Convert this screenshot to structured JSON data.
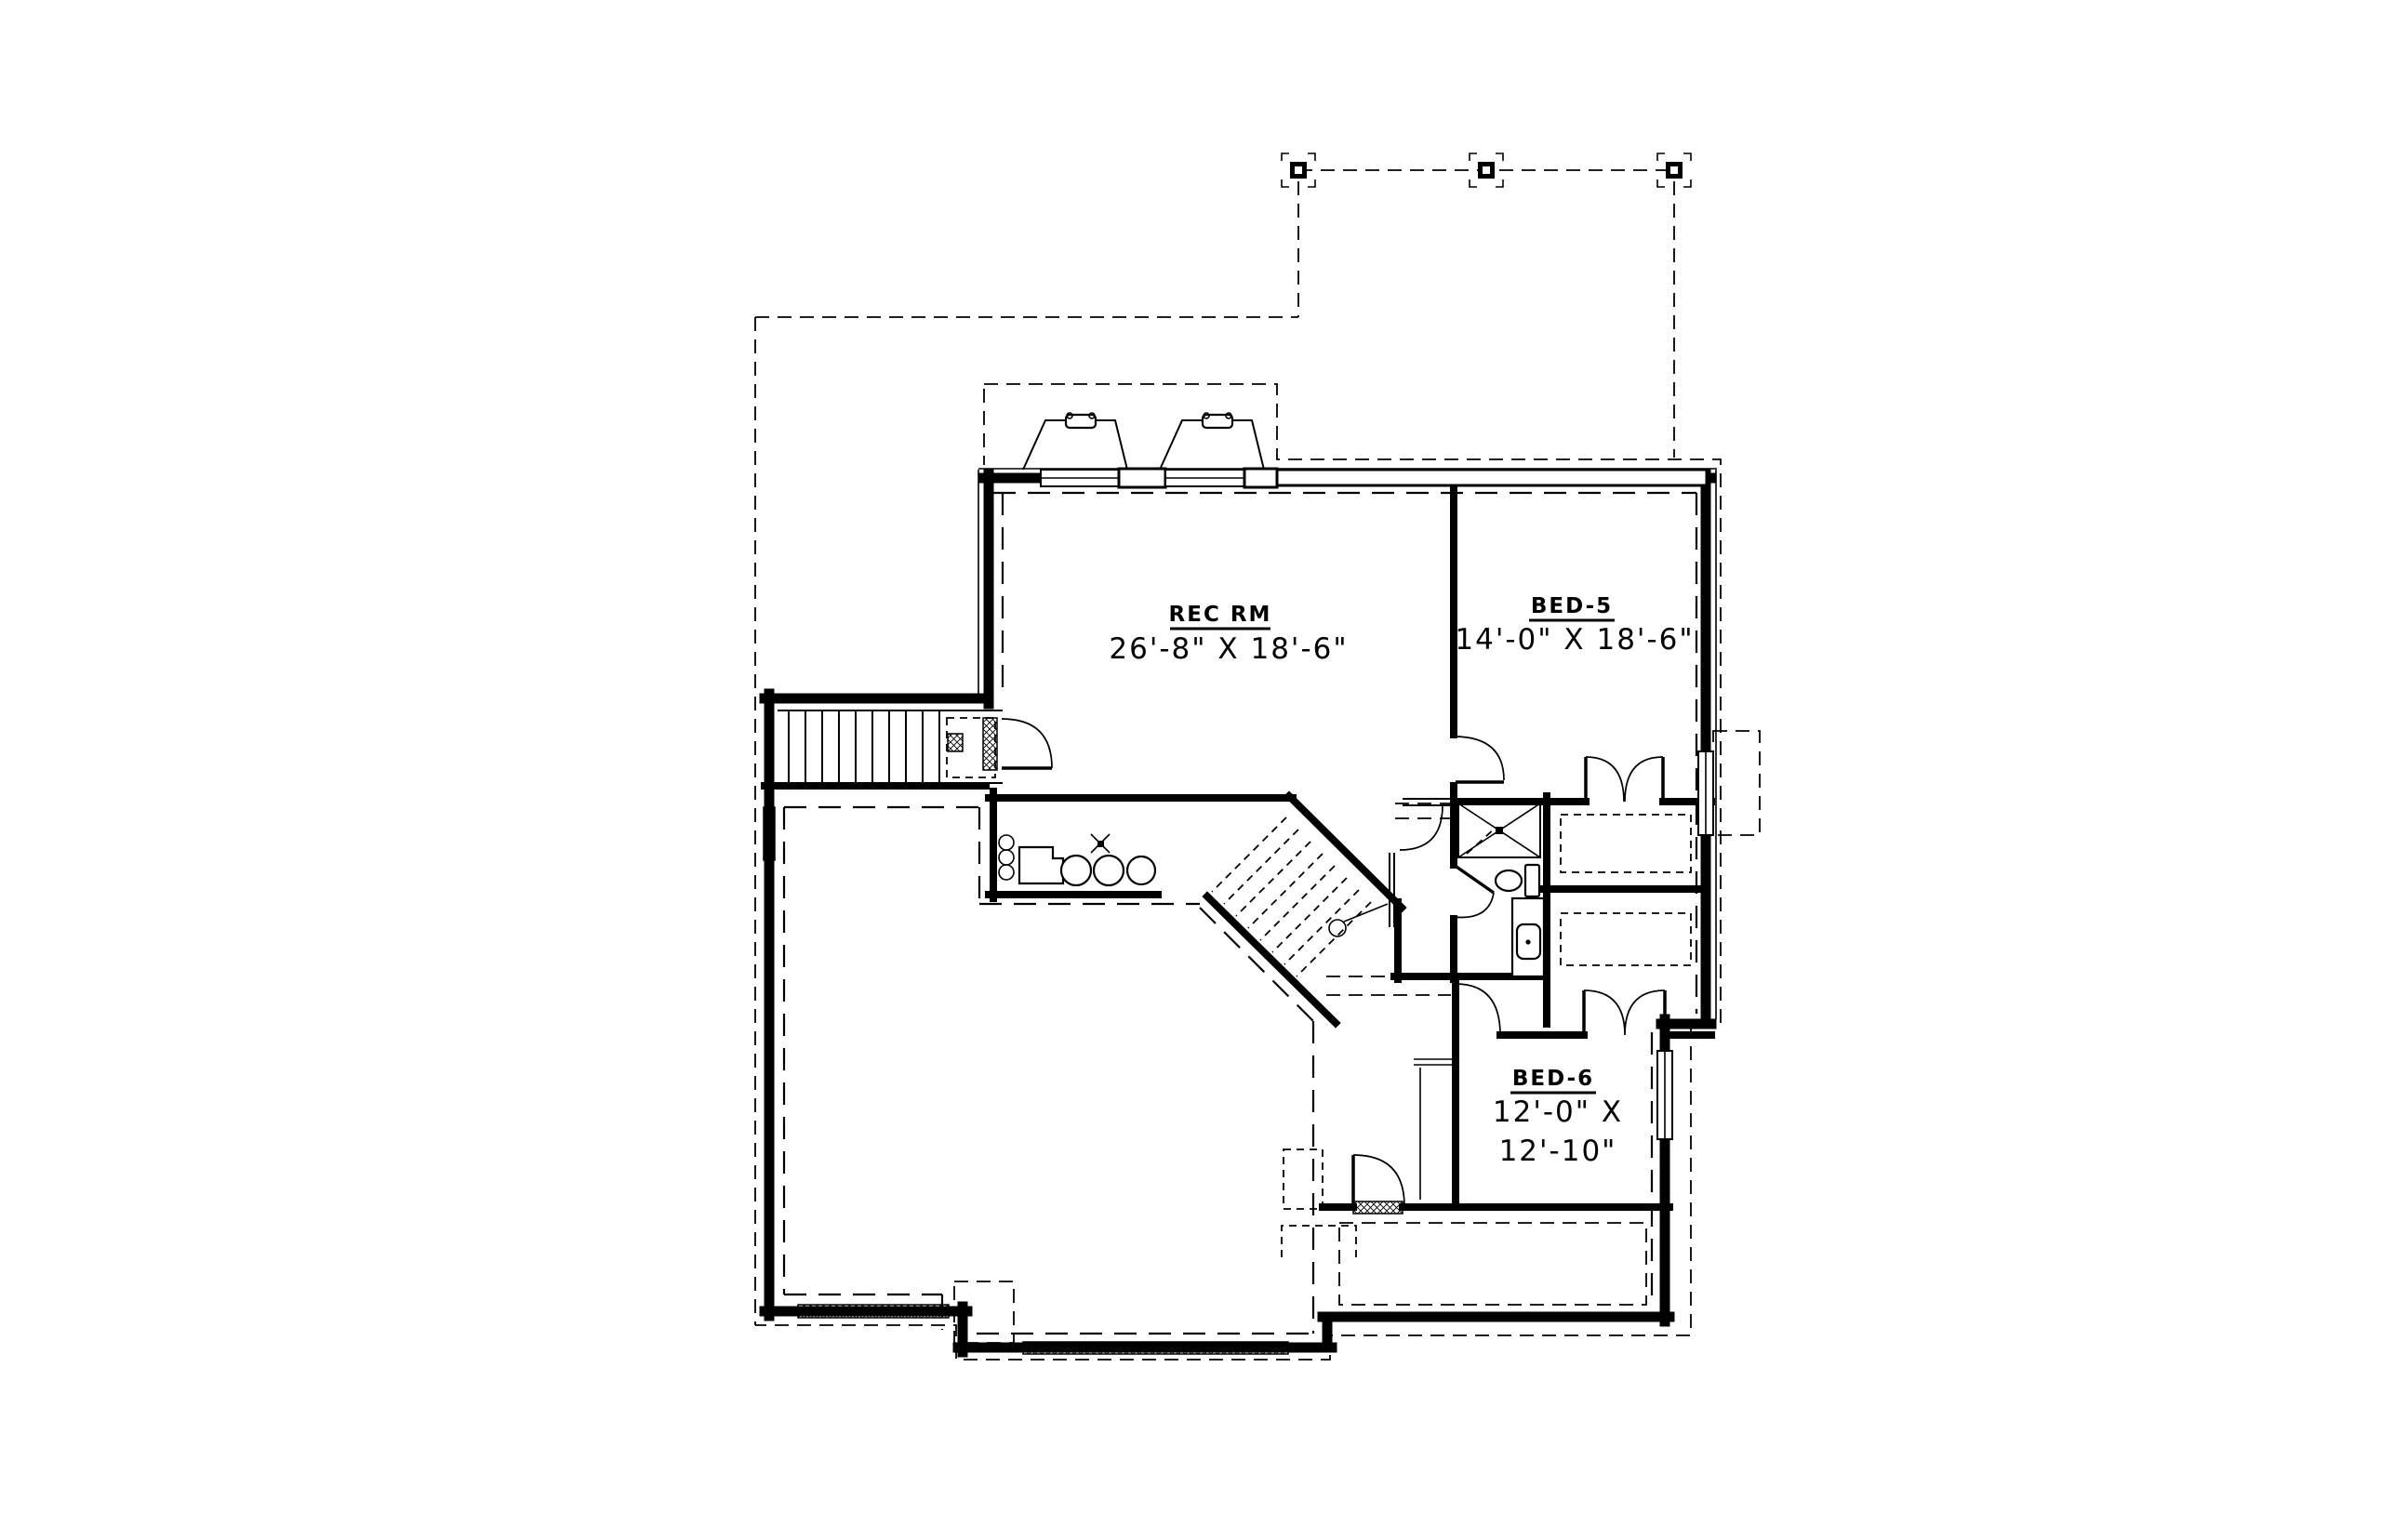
{
  "drawing": {
    "type": "basement floor plan",
    "background_color": "#ffffff",
    "line_color": "#000000"
  },
  "rooms": {
    "rec_room": {
      "name": "REC RM",
      "dimensions": "26'-8\" X 18'-6\""
    },
    "bed5": {
      "name": "BED-5",
      "dimensions": "14'-0\" X 18'-6\""
    },
    "bed6": {
      "name": "BED-6",
      "dimensions_line1": "12'-0\" X",
      "dimensions_line2": "12'-10\""
    }
  }
}
